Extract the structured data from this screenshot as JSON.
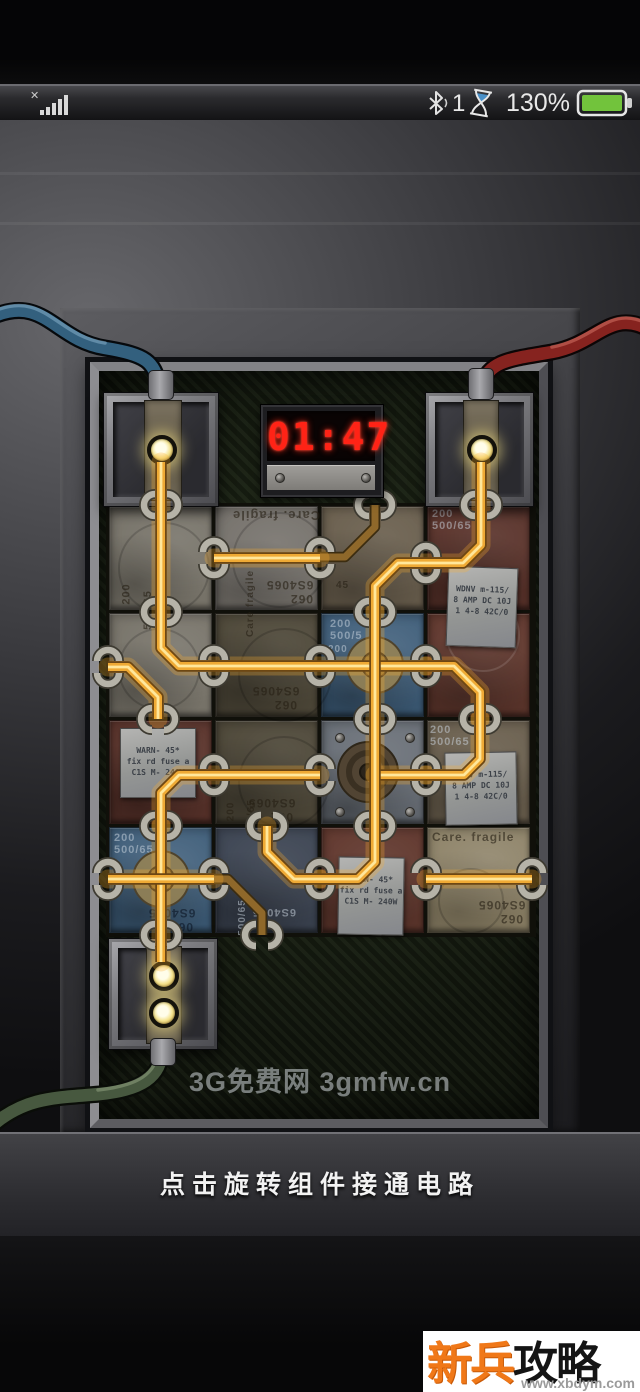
{
  "status_bar": {
    "signal_icon": "no-signal-x-with-bars",
    "bluetooth_count": "1",
    "battery_percent": "130%",
    "battery_color": "#72c33c"
  },
  "timer": {
    "value": "01:47",
    "digit_color": "#ff2316"
  },
  "watermark": {
    "text": "3G免费网 3gmfw.cn"
  },
  "caption": {
    "text": "点击旋转组件接通电路"
  },
  "logo": {
    "title_highlight": "新兵",
    "title_rest": "攻略网",
    "url": "www.xbdym.com"
  },
  "board": {
    "grid": {
      "cols_x": [
        108,
        214,
        320,
        426,
        532
      ],
      "rows_y": [
        505,
        612,
        719,
        826,
        935
      ]
    },
    "wire_colors": {
      "lit_core": "#ffe79b",
      "lit_mid": "#efaa35",
      "lit_edge": "#6d4713",
      "glow": "rgba(255,175,45,0.28)",
      "dim_mid": "#8f682a",
      "dim_edge": "#3c2d11"
    },
    "tiles": [
      {
        "r": 0,
        "c": 0,
        "color": "gray1"
      },
      {
        "r": 0,
        "c": 1,
        "color": "gray2"
      },
      {
        "r": 0,
        "c": 2,
        "color": "umber"
      },
      {
        "r": 0,
        "c": 3,
        "color": "maroon"
      },
      {
        "r": 1,
        "c": 0,
        "color": "gray1"
      },
      {
        "r": 1,
        "c": 1,
        "color": "olive"
      },
      {
        "r": 1,
        "c": 2,
        "color": "blue"
      },
      {
        "r": 1,
        "c": 3,
        "color": "maroon2"
      },
      {
        "r": 2,
        "c": 0,
        "color": "maroon"
      },
      {
        "r": 2,
        "c": 1,
        "color": "olive"
      },
      {
        "r": 2,
        "c": 2,
        "color": "steel"
      },
      {
        "r": 2,
        "c": 3,
        "color": "umber"
      },
      {
        "r": 3,
        "c": 0,
        "color": "blue"
      },
      {
        "r": 3,
        "c": 1,
        "color": "navy"
      },
      {
        "r": 3,
        "c": 2,
        "color": "maroon2"
      },
      {
        "r": 3,
        "c": 3,
        "color": "tan"
      }
    ],
    "rings": [
      {
        "x": 118,
        "y": 522,
        "d": 88,
        "lt": false
      },
      {
        "x": 232,
        "y": 512,
        "d": 92,
        "lt": false
      },
      {
        "x": 238,
        "y": 628,
        "d": 90,
        "lt": false
      },
      {
        "x": 238,
        "y": 736,
        "d": 88,
        "lt": false
      },
      {
        "x": 118,
        "y": 628,
        "d": 78,
        "lt": false
      },
      {
        "x": 438,
        "y": 868,
        "d": 62,
        "lt": false
      },
      {
        "x": 446,
        "y": 598,
        "d": 70,
        "lt": true
      }
    ],
    "stencils": [
      {
        "t": "Care. fragile",
        "x": 232,
        "y": 508,
        "rot": 180,
        "s": 13,
        "c": "dark"
      },
      {
        "t": "Care fragile",
        "x": 217,
        "y": 598,
        "rot": -90,
        "s": 10,
        "c": "dark"
      },
      {
        "t": "6S4065",
        "x": 266,
        "y": 578,
        "rot": 180,
        "s": 12,
        "c": "dark"
      },
      {
        "t": "062",
        "x": 290,
        "y": 592,
        "rot": 180,
        "s": 12,
        "c": "dark"
      },
      {
        "t": "200",
        "x": 116,
        "y": 588,
        "rot": -90,
        "s": 11,
        "c": "dark"
      },
      {
        "t": "500/65",
        "x": 128,
        "y": 604,
        "rot": -90,
        "s": 11,
        "c": "dark"
      },
      {
        "t": "200",
        "x": 432,
        "y": 508,
        "rot": 0,
        "s": 11,
        "c": "light"
      },
      {
        "t": "500/65",
        "x": 432,
        "y": 520,
        "rot": 0,
        "s": 11,
        "c": "light"
      },
      {
        "t": "45",
        "x": 336,
        "y": 580,
        "rot": 0,
        "s": 10,
        "c": "dark"
      },
      {
        "t": "6S4065",
        "x": 252,
        "y": 684,
        "rot": 180,
        "s": 12,
        "c": "dark"
      },
      {
        "t": "062",
        "x": 274,
        "y": 698,
        "rot": 180,
        "s": 12,
        "c": "dark"
      },
      {
        "t": "200",
        "x": 330,
        "y": 618,
        "rot": 0,
        "s": 11,
        "c": "light"
      },
      {
        "t": "500/5",
        "x": 330,
        "y": 630,
        "rot": 0,
        "s": 11,
        "c": "light"
      },
      {
        "t": "6S4065",
        "x": 248,
        "y": 796,
        "rot": 180,
        "s": 12,
        "c": "dark"
      },
      {
        "t": "062",
        "x": 270,
        "y": 810,
        "rot": 180,
        "s": 12,
        "c": "dark"
      },
      {
        "t": "200",
        "x": 221,
        "y": 806,
        "rot": -90,
        "s": 10,
        "c": "dark"
      },
      {
        "t": "500/65",
        "x": 233,
        "y": 812,
        "rot": -90,
        "s": 10,
        "c": "dark"
      },
      {
        "t": "200",
        "x": 430,
        "y": 724,
        "rot": 0,
        "s": 11,
        "c": "light"
      },
      {
        "t": "500/65",
        "x": 430,
        "y": 736,
        "rot": 0,
        "s": 11,
        "c": "light"
      },
      {
        "t": "200",
        "x": 114,
        "y": 832,
        "rot": 0,
        "s": 11,
        "c": "light"
      },
      {
        "t": "500/65",
        "x": 114,
        "y": 844,
        "rot": 0,
        "s": 11,
        "c": "light"
      },
      {
        "t": "6S4065",
        "x": 148,
        "y": 906,
        "rot": 180,
        "s": 12,
        "c": "darkb"
      },
      {
        "t": "062",
        "x": 170,
        "y": 920,
        "rot": 180,
        "s": 12,
        "c": "darkb"
      },
      {
        "t": "500/65",
        "x": 224,
        "y": 912,
        "rot": -90,
        "s": 10,
        "c": "light"
      },
      {
        "t": "6S4065",
        "x": 252,
        "y": 906,
        "rot": 180,
        "s": 11,
        "c": "light"
      },
      {
        "t": "Care. fragile",
        "x": 432,
        "y": 830,
        "rot": 0,
        "s": 12,
        "c": "dark"
      },
      {
        "t": "6S4065",
        "x": 478,
        "y": 898,
        "rot": 180,
        "s": 12,
        "c": "dark"
      },
      {
        "t": "062",
        "x": 500,
        "y": 912,
        "rot": 180,
        "s": 12,
        "c": "dark"
      },
      {
        "t": "200",
        "x": 328,
        "y": 644,
        "rot": 0,
        "s": 10,
        "c": "light"
      }
    ],
    "plates": [
      {
        "x": 447,
        "y": 567,
        "w": 70,
        "h": 80,
        "rot": 2,
        "lines": [
          "WDNV m-115/",
          "8 AMP DC 10J",
          "1 4-8 42C/0"
        ]
      },
      {
        "x": 120,
        "y": 728,
        "w": 76,
        "h": 70,
        "rot": 0,
        "lines": [
          "WARN- 45*",
          "fix rd fuse a",
          "C1S M- 240W"
        ]
      },
      {
        "x": 445,
        "y": 752,
        "w": 72,
        "h": 73,
        "rot": -1,
        "lines": [
          "WDNV m-115/",
          "8 AMP DC 10J",
          "1 4-8 42C/0"
        ]
      },
      {
        "x": 338,
        "y": 857,
        "w": 66,
        "h": 78,
        "rot": 1,
        "lines": [
          "WARN- 45*",
          "fix rd fuse a",
          "C1S M- 240W"
        ]
      }
    ],
    "hubs": [
      {
        "x": 375,
        "y": 665
      },
      {
        "x": 161,
        "y": 879
      }
    ],
    "coil": {
      "x": 368,
      "y": 772
    },
    "screw_tile": {
      "x": 320,
      "y": 719,
      "w": 106,
      "h": 107
    },
    "wires": {
      "lit": [
        "M161,462 L161,648 L179,666 L426,666",
        "M426,666 L454,666 L480,692 L480,719",
        "M480,719 L480,759 L464,775 L426,775",
        "M426,775 L375,775",
        "M375,612 L375,862 L358,879 L320,879",
        "M481,462 L481,545 L463,563 L398,563 L375,586 L375,612",
        "M214,558 L320,558",
        "M108,667 L128,667 L158,697 L158,719",
        "M161,826 L161,793 L179,775 L320,775",
        "M161,826 L161,962",
        "M108,879 L214,879",
        "M267,826 L267,852 L294,879 L320,879",
        "M426,879 L532,879"
      ],
      "dim": [
        "M375,505 L375,527 L345,557 L320,557",
        "M214,879 L228,879 L262,913 L262,935"
      ]
    },
    "clips": {
      "v": [
        [
          161,
          505
        ],
        [
          161,
          612
        ],
        [
          158,
          719
        ],
        [
          161,
          826
        ],
        [
          161,
          935
        ],
        [
          375,
          505
        ],
        [
          375,
          612
        ],
        [
          375,
          719
        ],
        [
          375,
          826
        ],
        [
          481,
          505
        ],
        [
          480,
          719
        ],
        [
          267,
          826
        ],
        [
          262,
          935
        ]
      ],
      "h": [
        [
          214,
          558
        ],
        [
          320,
          558
        ],
        [
          426,
          563
        ],
        [
          108,
          667
        ],
        [
          214,
          666
        ],
        [
          320,
          666
        ],
        [
          426,
          666
        ],
        [
          214,
          775
        ],
        [
          320,
          775
        ],
        [
          426,
          775
        ],
        [
          108,
          879
        ],
        [
          214,
          879
        ],
        [
          320,
          879
        ],
        [
          426,
          879
        ],
        [
          532,
          879
        ]
      ]
    },
    "cables": [
      {
        "name": "blue-cable",
        "d": "M-6,316 C45,295 55,340 105,348 C148,355 153,362 159,384",
        "sheen_d": "M-6,311 C45,290 55,335 105,343",
        "color": "#33607e",
        "outline": "#06090c",
        "sheen": "rgba(165,205,230,0.4)"
      },
      {
        "name": "red-cable",
        "d": "M646,328 C610,310 596,344 552,352 C512,359 488,360 482,386",
        "sheen_d": "M646,323 C610,305 596,339 552,347",
        "color": "#86231f",
        "outline": "#0c0606",
        "sheen": "rgba(255,160,140,0.35)"
      },
      {
        "name": "green-cable",
        "d": "M162,1048 C162,1078 140,1090 100,1094 C58,1098 28,1096 -6,1124",
        "sheen_d": "M158,1048 C158,1074 136,1086 98,1090",
        "color": "#47583f",
        "outline": "#0a0d08",
        "sheen": "rgba(195,215,175,0.32)"
      }
    ],
    "terminals": {
      "top_left": {
        "leds": 1,
        "cable": "blue"
      },
      "top_right": {
        "leds": 1,
        "cable": "red"
      },
      "bottom_left": {
        "leds": 2,
        "cable": "green"
      }
    }
  }
}
